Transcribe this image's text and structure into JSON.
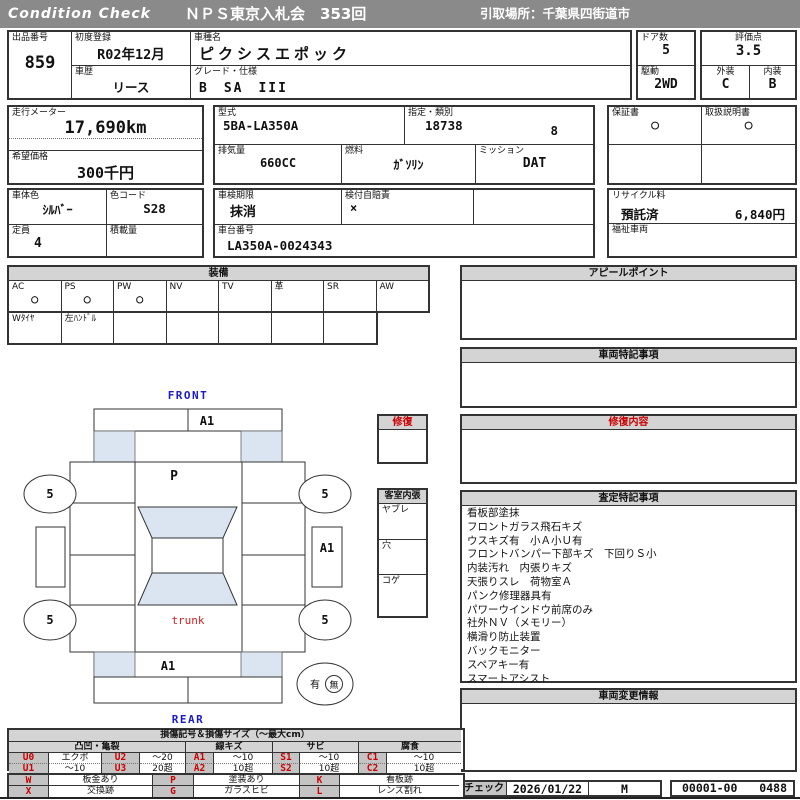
{
  "colors": {
    "header_bg": "#8a8a8a",
    "section_header_bg": "#d4d4d4",
    "accent_red": "#cc0000",
    "accent_blue": "#1a1acc",
    "diagram_shade": "#dbe5f1",
    "legend_code_bg": "#c4c4c4"
  },
  "header": {
    "brand": "Condition  Check",
    "title": "ＮＰＳ東京入札会　353回",
    "pickup": "引取場所：千葉県四街道市"
  },
  "info": {
    "lot": {
      "label": "出品番号",
      "value": "859"
    },
    "first_reg": {
      "label": "初度登録",
      "value": "R02年12月"
    },
    "history": {
      "label": "車歴",
      "value": "リース"
    },
    "model_name": {
      "label": "車種名",
      "value": "ピクシスエポック"
    },
    "grade": {
      "label": "グレード・仕様",
      "value": "B　SA　III"
    },
    "doors": {
      "label": "ドア数",
      "value": "5"
    },
    "drive": {
      "label": "駆動",
      "value": "2WD"
    },
    "score": {
      "label": "評価点",
      "value": "3.5"
    },
    "exterior": {
      "label": "外装",
      "value": "C"
    },
    "interior": {
      "label": "内装",
      "value": "B"
    },
    "odometer": {
      "label": "走行メーター",
      "value": "17,690km"
    },
    "price": {
      "label": "希望価格",
      "value": "300千円"
    },
    "model_code": {
      "label": "型式",
      "value": "5BA-LA350A"
    },
    "type_class": {
      "label": "指定・類別",
      "value1": "18738",
      "value2": "8"
    },
    "displacement": {
      "label": "排気量",
      "value": "660CC"
    },
    "fuel": {
      "label": "燃料",
      "value": "ｶﾞｿﾘﾝ"
    },
    "mission": {
      "label": "ミッション",
      "value": "DAT"
    },
    "warranty": {
      "label": "保証書",
      "value": "○"
    },
    "manual": {
      "label": "取扱説明書",
      "value": "○"
    },
    "body_color": {
      "label": "車体色",
      "value": "ｼﾙﾊﾞｰ"
    },
    "color_code": {
      "label": "色コード",
      "value": "S28"
    },
    "inspection": {
      "label": "車検期限",
      "value": "抹消"
    },
    "insurance": {
      "label": "検付自賠責",
      "value": "×"
    },
    "recycle": {
      "label": "リサイクル料",
      "value1": "預託済",
      "value2": "6,840円"
    },
    "capacity": {
      "label": "定員",
      "value": "4"
    },
    "load": {
      "label": "積載量",
      "value": ""
    },
    "vin": {
      "label": "車台番号",
      "value": "LA350A-0024343"
    },
    "welfare": {
      "label": "福祉車両",
      "value": ""
    }
  },
  "equipment": {
    "title": "装備",
    "row1": [
      {
        "label": "AC",
        "mark": "○"
      },
      {
        "label": "PS",
        "mark": "○"
      },
      {
        "label": "PW",
        "mark": "○"
      },
      {
        "label": "NV",
        "mark": ""
      },
      {
        "label": "TV",
        "mark": ""
      },
      {
        "label": "革",
        "mark": ""
      },
      {
        "label": "SR",
        "mark": ""
      },
      {
        "label": "AW",
        "mark": ""
      }
    ],
    "row2": [
      "Wﾀｲﾔ",
      "左ﾊﾝﾄﾞﾙ",
      "",
      "",
      "",
      "",
      ""
    ]
  },
  "sections": {
    "appeal": {
      "title": "アピールポイント",
      "body": ""
    },
    "vehicle_notes": {
      "title": "車両特記事項",
      "body": ""
    },
    "repair": {
      "title": "修復内容",
      "body": ""
    },
    "assessment": {
      "title": "査定特記事項",
      "lines": [
        "看板部塗抹",
        "フロントガラス飛石キズ",
        "ウスキズ有　小Ａ小Ｕ有",
        "フロントバンパー下部キズ　下回りＳ小",
        "内装汚れ　内張りキズ",
        "天張りスレ　荷物室Ａ",
        "パンク修理器具有",
        "パワーウインドウ前席のみ",
        "社外ＮＶ（メモリー）",
        "横滑り防止装置",
        "バックモニター",
        "スペアキー有",
        "スマートアシスト"
      ]
    },
    "change_info": {
      "title": "車両変更情報",
      "body": ""
    }
  },
  "diagram": {
    "front_label": "FRONT",
    "rear_label": "REAR",
    "trunk_label": "trunk",
    "bonnet_mark": "P",
    "front_bumper_mark": "A1",
    "right_side_mark": "A1",
    "rear_gate_mark": "A1",
    "wheels": [
      "5",
      "5",
      "5",
      "5"
    ],
    "repair_box_title": "修復",
    "cabin_box": {
      "title": "客室内張",
      "rows": [
        "ヤブレ",
        "穴",
        "コゲ"
      ]
    },
    "history_oval": {
      "yes": "有",
      "no": "無"
    }
  },
  "legend": {
    "title": "損傷記号＆損傷サイズ（～最大cm）",
    "groups": [
      "凸凹・亀裂",
      "線キズ",
      "サビ",
      "腐食"
    ],
    "row1": [
      {
        "c": "U0",
        "v": "エクボ"
      },
      {
        "c": "U2",
        "v": "～20"
      },
      {
        "c": "A1",
        "v": "～10"
      },
      {
        "c": "S1",
        "v": "～10"
      },
      {
        "c": "C1",
        "v": "～10"
      }
    ],
    "row2": [
      {
        "c": "U1",
        "v": "～10"
      },
      {
        "c": "U3",
        "v": "20超"
      },
      {
        "c": "A2",
        "v": "10超"
      },
      {
        "c": "S2",
        "v": "10超"
      },
      {
        "c": "C2",
        "v": "10超"
      }
    ],
    "row3": [
      {
        "c": "W",
        "v": "板金あり"
      },
      {
        "c": "P",
        "v": "塗装あり"
      },
      {
        "c": "K",
        "v": "看板跡"
      }
    ],
    "row4": [
      {
        "c": "X",
        "v": "交換跡"
      },
      {
        "c": "G",
        "v": "ガラスヒビ"
      },
      {
        "c": "L",
        "v": "レンズ割れ"
      }
    ]
  },
  "footer": {
    "check_label": "チェック",
    "date": "2026/01/22",
    "inspector": "M",
    "code1": "00001-00",
    "code2": "0488"
  }
}
